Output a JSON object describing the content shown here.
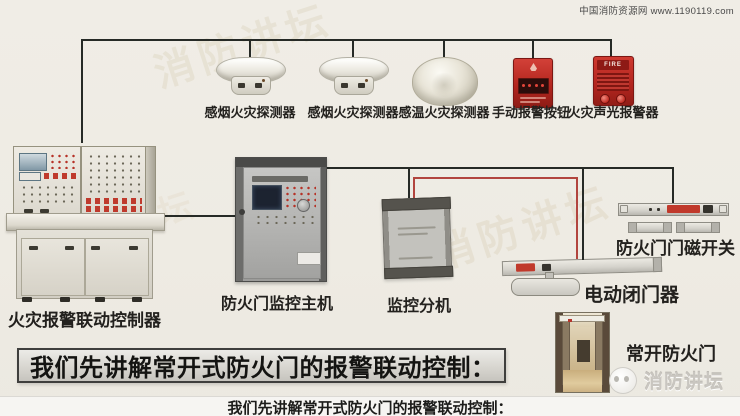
{
  "header": {
    "credit": "中国消防资源网 www.1190119.com"
  },
  "devices": {
    "smoke_detector_1": {
      "label": "感烟火灾探测器"
    },
    "smoke_detector_2": {
      "label": "感烟火灾探测器"
    },
    "heat_detector": {
      "label": "感温火灾探测器"
    },
    "manual_call_point": {
      "label": "手动报警按钮"
    },
    "sounder_strobe": {
      "label": "火灾声光报警器",
      "badge": "FIRE"
    },
    "fire_alarm_controller": {
      "label": "火灾报警联动控制器"
    },
    "door_monitor_host": {
      "label": "防火门监控主机"
    },
    "monitor_extension": {
      "label": "监控分机"
    },
    "door_magnetic_switch": {
      "label": "防火门门磁开关"
    },
    "electric_door_closer": {
      "label": "电动闭门器"
    },
    "normally_open_door": {
      "label": "常开防火门"
    }
  },
  "banner": {
    "text": "我们先讲解常开式防火门的报警联动控制："
  },
  "subtitle": {
    "text": "我们先讲解常开式防火门的报警联动控制："
  },
  "logo": {
    "text": "消防讲坛"
  },
  "watermark": {
    "text": "消防讲坛"
  },
  "colors": {
    "background": "#efece5",
    "wire_dark": "#262a26",
    "wire_red": "#b2453e",
    "device_red": "#c0392b",
    "banner_border": "#3f3f3d"
  }
}
